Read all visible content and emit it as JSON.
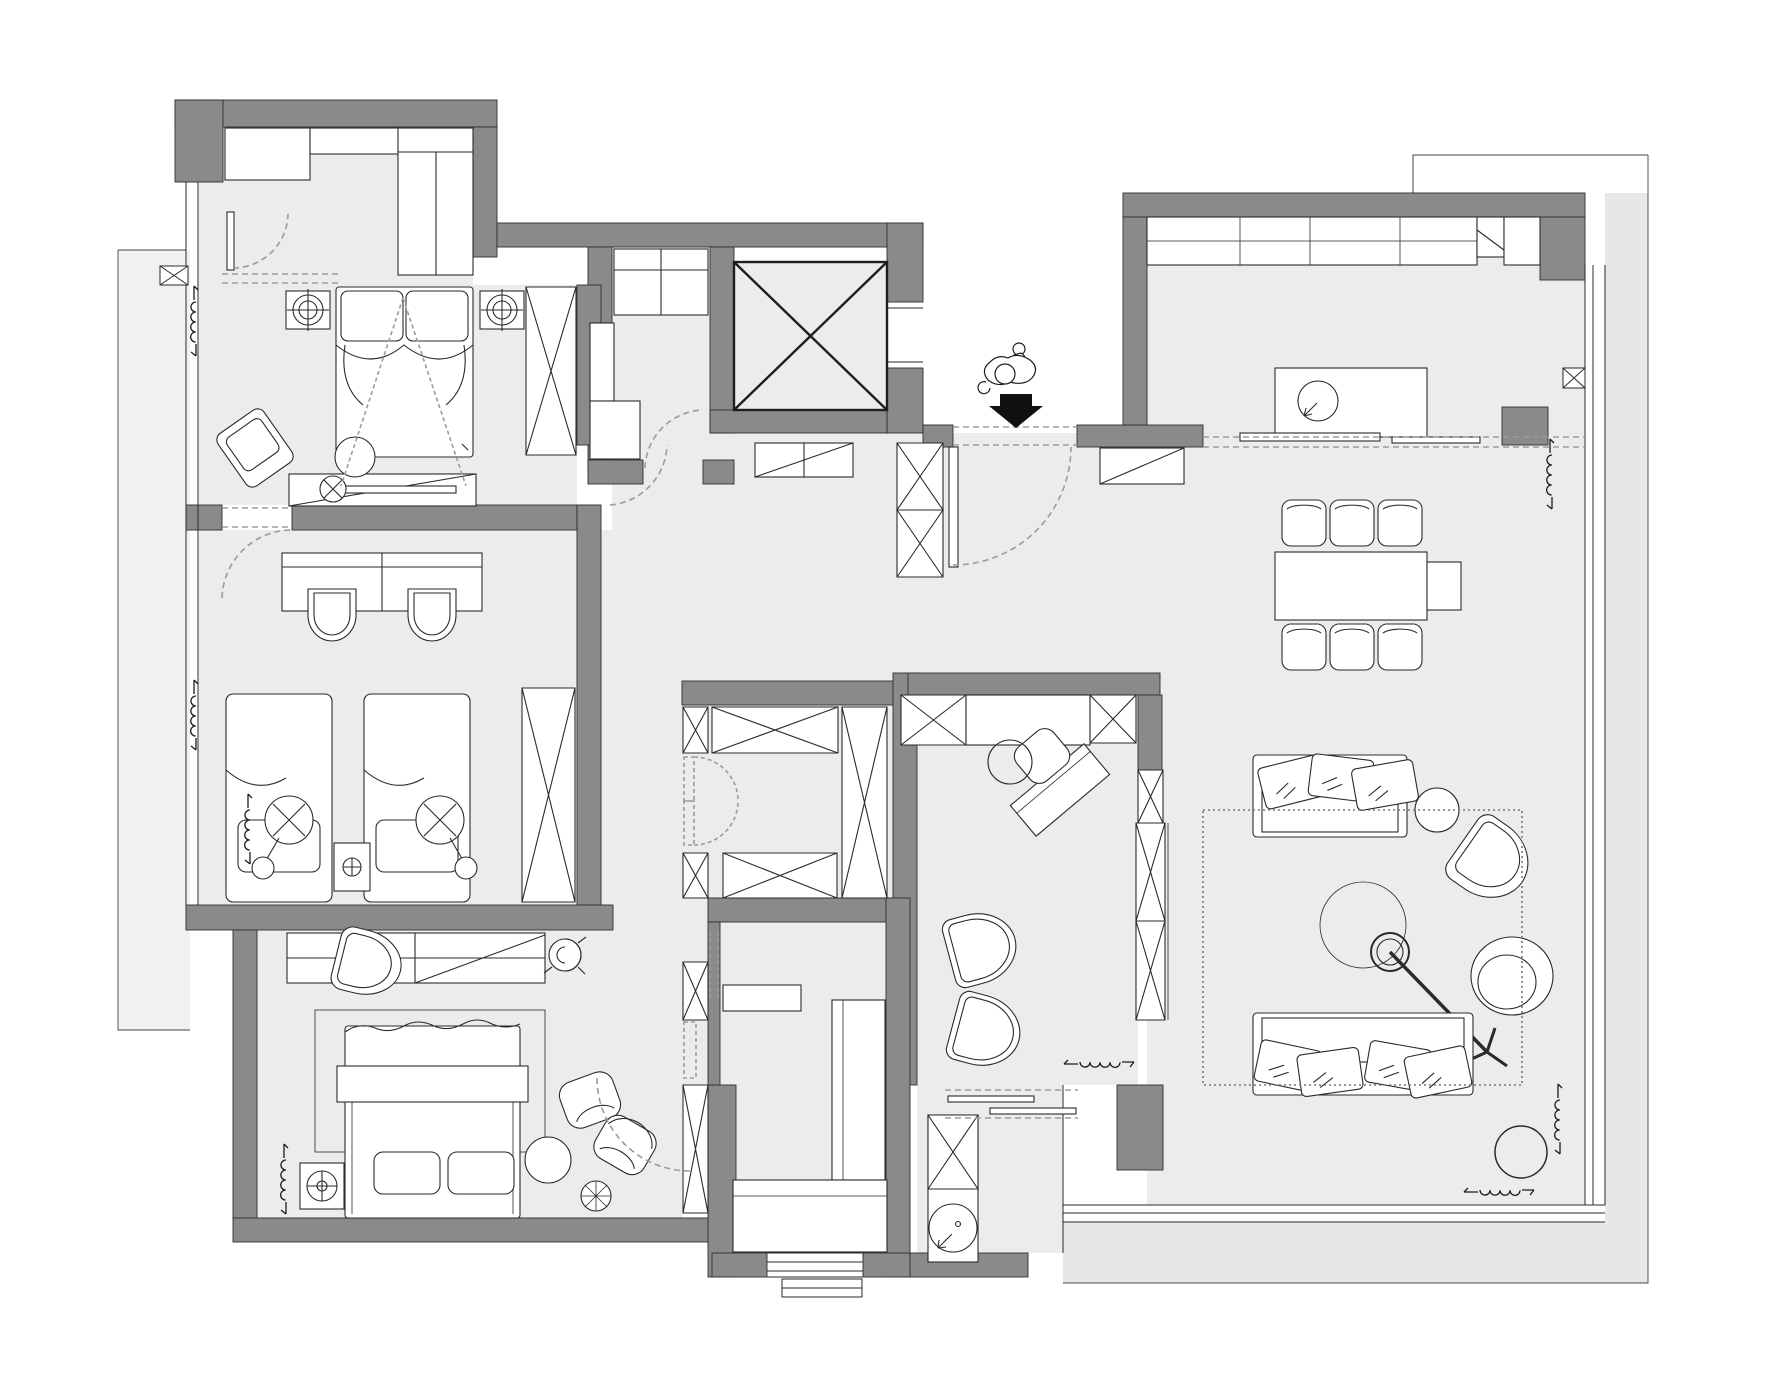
{
  "canvas": {
    "width": 1778,
    "height": 1380,
    "type": "floor-plan",
    "style": "CAD interior layout, top view, monochrome, no text labels"
  },
  "colors": {
    "background": "#ffffff",
    "floor": "#ececec",
    "balcony": "#e7e7e7",
    "shaft": "#e9e9e9",
    "wall": "#8a8a8a",
    "wall_outline": "#2f2f2f",
    "line": "#2a2a2a",
    "dashed": "#9b9b9b",
    "black": "#111111"
  },
  "rooms": [
    {
      "name": "dressing-room",
      "furniture": [
        "built-in-closet-left",
        "built-in-closet-top",
        "built-in-closet-right",
        "swing-door"
      ]
    },
    {
      "name": "bedroom-1",
      "furniture": [
        "double-bed",
        "pillow x2",
        "nightstand x2",
        "ceiling-light x2",
        "wardrobe-x",
        "tv-cabinet",
        "armchair",
        "round-stool",
        "floor-lamp",
        "projection-dashed-lines"
      ]
    },
    {
      "name": "kids-bedroom",
      "furniture": [
        "double-desk",
        "desk-chair x2",
        "single-bed x2",
        "center-nightstand",
        "hanging-lamp x2",
        "wardrobe-x"
      ]
    },
    {
      "name": "master-bedroom",
      "furniture": [
        "long-dresser",
        "ceiling-fan-spiral",
        "rug",
        "lounge-chair",
        "double-bed",
        "pillow x2",
        "lamp-box",
        "armchair x2",
        "round-table",
        "spoke-wheel-stool",
        "radiator-coil"
      ]
    },
    {
      "name": "walk-in-closet",
      "furniture": [
        "wardrobe-x-top",
        "wardrobe-x-right",
        "wardrobe-x-bottom",
        "bifold-doors"
      ]
    },
    {
      "name": "corridor",
      "furniture": [
        "shallow-cabinet-x x4",
        "swing-door-to-master"
      ]
    },
    {
      "name": "pantry",
      "furniture": [
        "upper-cabinets",
        "tall-shelf",
        "base-cabinet",
        "swing-door"
      ]
    },
    {
      "name": "elevator",
      "furniture": [
        "shaft-cross"
      ]
    },
    {
      "name": "foyer",
      "furniture": [
        "cabinet-diagonal",
        "shoe-cabinet-xx",
        "entry-opening",
        "entry-door-leaf",
        "swing-arc"
      ]
    },
    {
      "name": "study",
      "furniture": [
        "cabinet-row-x",
        "cabinet-row-plain",
        "rotated-desk",
        "desk-chair",
        "d-chair x2",
        "tall-cabinet-xx"
      ]
    },
    {
      "name": "master-bathroom",
      "furniture": [
        "wall-shelf",
        "shower-glass-panel",
        "bench",
        "window-with-steps"
      ]
    },
    {
      "name": "vanity-bathroom",
      "furniture": [
        "vanity-cabinet-x",
        "round-washbasin",
        "towel-bar x2",
        "dashed-opening"
      ]
    },
    {
      "name": "kitchen",
      "furniture": [
        "counter-run",
        "refrigerator-fold",
        "corner-unit",
        "island-with-sink",
        "threshold-dashed-lines",
        "radiator-coil"
      ]
    },
    {
      "name": "dining-area",
      "furniture": [
        "dining-table",
        "table-extension",
        "dining-chair x6",
        "entry-sideboard"
      ]
    },
    {
      "name": "living-area",
      "furniture": [
        "sofa-top",
        "sofa-bottom",
        "throw-pillows x7",
        "round-side-table",
        "curved-armchair",
        "arc-floor-lamp",
        "tripod-base",
        "pouf",
        "dotted-rug",
        "plant-pot",
        "radiator-coil x2",
        "tv-wall-cabinet-xx"
      ]
    },
    {
      "name": "balcony-left",
      "furniture": [
        "radiator-coil x2",
        "window-mullion-x"
      ]
    },
    {
      "name": "balcony-right",
      "furniture": [
        "window-band",
        "window-mullion-x"
      ]
    },
    {
      "name": "balcony-bottom",
      "furniture": [
        "window-band"
      ]
    }
  ],
  "symbols": [
    "wall-fill",
    "window-triple-line",
    "door-swing-arc",
    "cased-opening-dashed",
    "wardrobe-x-box",
    "elevator-shaft-cross",
    "ceiling-light-crosshair",
    "radiator-coil",
    "entry-person-figure",
    "entry-direction-arrow"
  ],
  "entry": {
    "figure": "person-at-door",
    "arrow_direction": "down"
  }
}
